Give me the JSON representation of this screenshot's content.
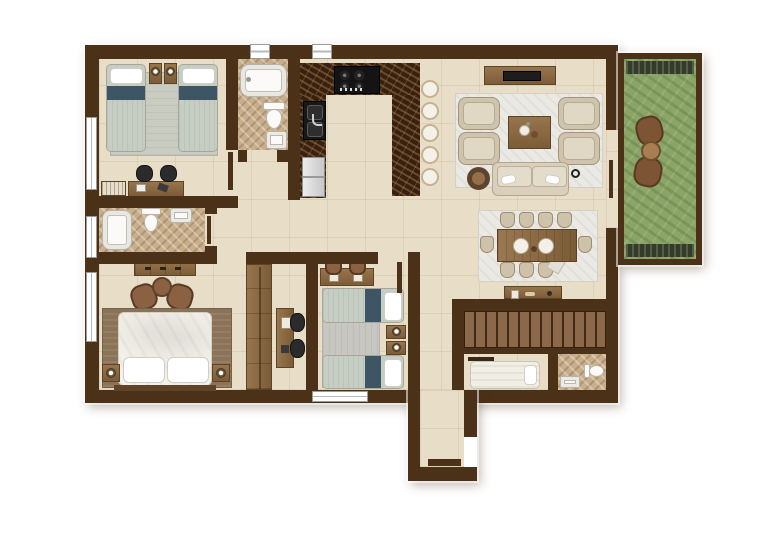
{
  "plan": {
    "type": "residential-floor-plan-top-view",
    "units_shown": "none (no text or dimensions rendered)",
    "counts": {
      "bar_stools": 5,
      "dining_seats": 10,
      "stair_treads": 13,
      "bedrooms": 3,
      "bathrooms": 3
    },
    "rooms": [
      {
        "name": "twin-bedroom-top-left",
        "furniture": [
          "twin-bed",
          "twin-bed",
          "nightstand",
          "nightstand",
          "table-lamp",
          "table-lamp",
          "area-rug",
          "vanity-desk",
          "stool",
          "stool",
          "storage-bench"
        ]
      },
      {
        "name": "family-bathroom-top",
        "furniture": [
          "bathtub",
          "toilet",
          "washbasin"
        ]
      },
      {
        "name": "kitchen",
        "furniture": [
          "u-shaped-marble-counter",
          "cooktop",
          "double-sink",
          "refrigerator",
          "breakfast-bar",
          "bar-stools"
        ]
      },
      {
        "name": "living-room",
        "furniture": [
          "tv-console",
          "television",
          "area-rug",
          "armchair",
          "armchair",
          "armchair",
          "armchair",
          "coffee-table",
          "sofa",
          "round-side-table",
          "decor-item"
        ]
      },
      {
        "name": "balcony-garden",
        "furniture": [
          "grass-lawn",
          "planter-strip",
          "planter-strip",
          "outdoor-chair",
          "outdoor-chair",
          "round-outdoor-table",
          "sliding-door"
        ]
      },
      {
        "name": "ensuite-bathroom-left",
        "furniture": [
          "bathtub",
          "toilet",
          "washbasin"
        ]
      },
      {
        "name": "master-bedroom",
        "furniture": [
          "double-bed",
          "pillow",
          "pillow",
          "headboard",
          "nightstand",
          "nightstand",
          "table-lamp",
          "table-lamp",
          "area-rug",
          "dresser",
          "lounge-chair",
          "lounge-chair",
          "round-table",
          "wardrobe",
          "desk",
          "desk-chair",
          "desk-chair"
        ]
      },
      {
        "name": "twin-bedroom-middle",
        "furniture": [
          "twin-bed",
          "twin-bed",
          "nightstand",
          "nightstand",
          "table-lamp",
          "table-lamp",
          "area-rug",
          "desk",
          "desk-chair",
          "desk-chair",
          "window"
        ]
      },
      {
        "name": "dining-area",
        "furniture": [
          "dining-table",
          "dining-chairs",
          "place-settings",
          "area-rug",
          "sideboard"
        ]
      },
      {
        "name": "staircase",
        "furniture": [
          "stair-treads",
          "railing-wall"
        ]
      },
      {
        "name": "maid-room",
        "furniture": [
          "single-bed",
          "wall-shelf"
        ]
      },
      {
        "name": "maid-bathroom",
        "furniture": [
          "toilet",
          "washbasin"
        ]
      },
      {
        "name": "entry-hall",
        "furniture": [
          "entry-door-opening",
          "door-mat"
        ]
      }
    ],
    "openings": [
      "left-wall-window-1",
      "left-wall-window-2",
      "left-wall-window-3",
      "top-wall-window-1",
      "top-wall-window-2",
      "bottom-wall-window",
      "balcony-sliding-door",
      "entry-door"
    ]
  },
  "palette": {
    "wall": "#4a3118",
    "floor": "#e8ddc7",
    "marble": "#c8ae8b",
    "counter": "#38200f",
    "grass": "#8ba566",
    "planter": "#333b2a",
    "teal": "#3e5565",
    "sage": "#c6cdc2",
    "grayRug": "#c8c6c0",
    "sageRug": "#c9ccc0",
    "brownRug": "#8b7358",
    "creamRug": "#ebe9e4",
    "stairsWood": "#7a5a3e",
    "fixtureWhite": "#fbfaf8",
    "furnitureWood": "#8a6844"
  }
}
